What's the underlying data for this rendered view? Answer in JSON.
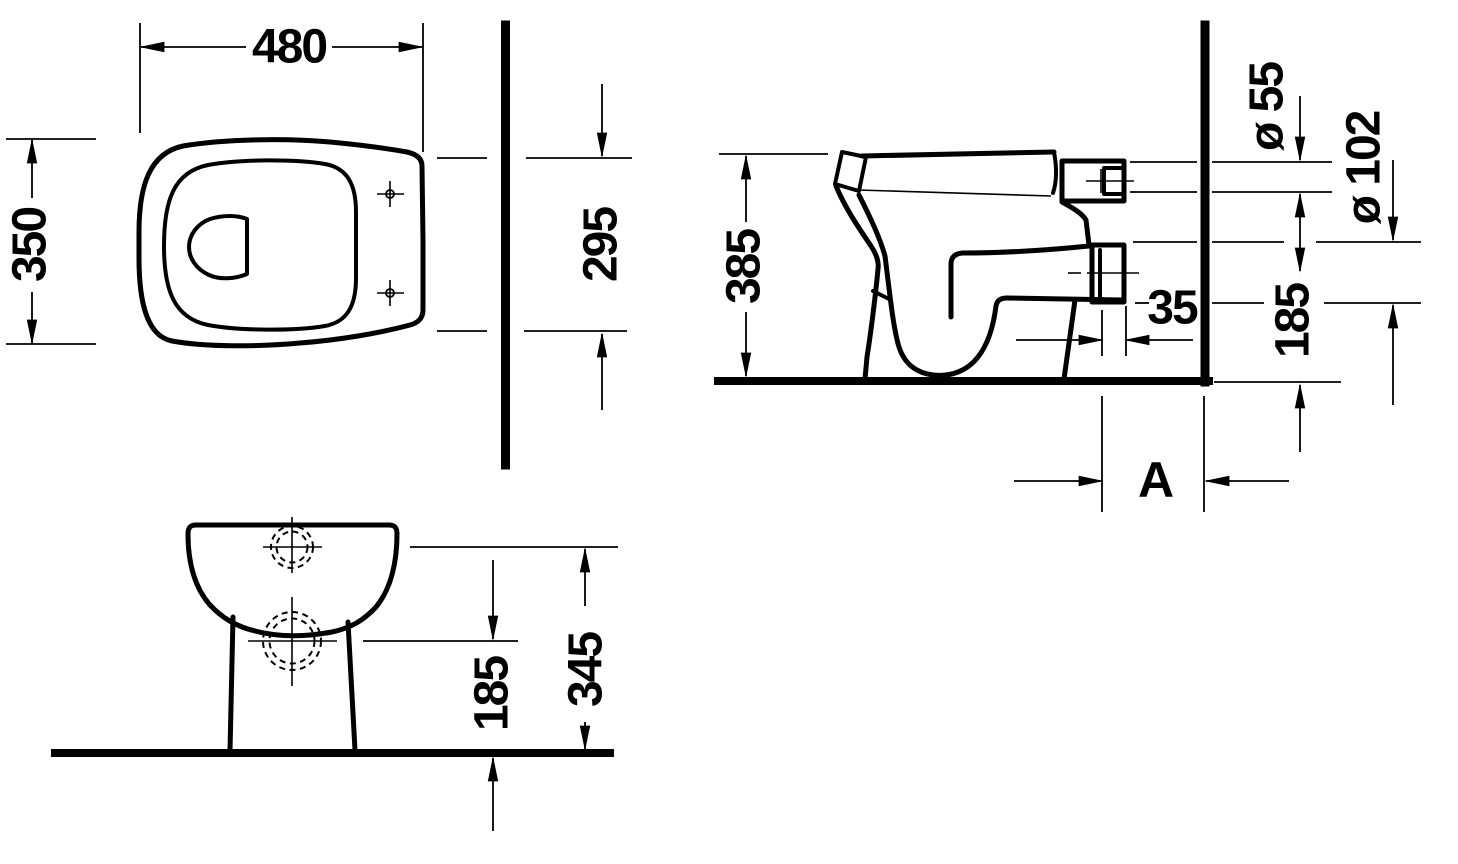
{
  "drawing": {
    "background": "#ffffff",
    "ink": "#000000",
    "plan": {
      "width": "480",
      "depth": "350",
      "back_width": "295"
    },
    "side": {
      "height": "385",
      "inlet_diameter": "ø 55",
      "outlet_diameter": "ø 102",
      "outlet_projection": "35",
      "outlet_axis_height": "185",
      "wall_distance_label": "A"
    },
    "front": {
      "outlet_axis_height": "185",
      "inlet_axis_height": "345"
    }
  }
}
